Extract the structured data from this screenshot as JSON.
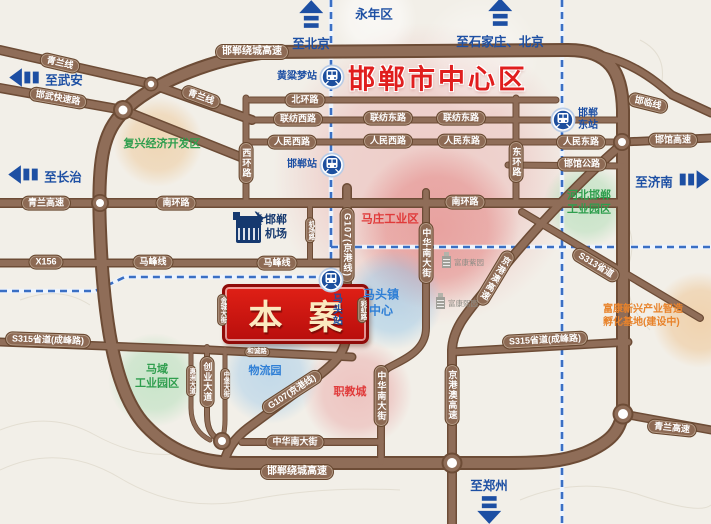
{
  "title": {
    "text": "邯郸市中心区",
    "x": 438,
    "y": 77,
    "color": "#e01e1e"
  },
  "project": {
    "label": "本案",
    "x": 222,
    "y": 284,
    "w": 141,
    "h": 54,
    "color": "#c41412"
  },
  "airport": {
    "line1": "邯郸",
    "line2": "机场"
  },
  "palette": {
    "road": "#8d6a54",
    "road_edge": "#6d4c36",
    "railway": "#3a6fc4",
    "direction": "#1d4fa3"
  },
  "directions": [
    {
      "label": "至北京",
      "arrow": "up",
      "axis": "col",
      "order": "arrow-first",
      "x": 311,
      "y": 26
    },
    {
      "label": "永年区",
      "arrow": "none",
      "axis": "row",
      "order": "text-first",
      "x": 374,
      "y": 13
    },
    {
      "label": "至石家庄、北京",
      "arrow": "up",
      "axis": "col",
      "order": "arrow-first",
      "x": 500,
      "y": 24
    },
    {
      "label": "至武安",
      "arrow": "left",
      "axis": "row",
      "order": "arrow-first",
      "x": 46,
      "y": 79
    },
    {
      "label": "至长治",
      "arrow": "left",
      "axis": "row",
      "order": "arrow-first",
      "x": 45,
      "y": 176
    },
    {
      "label": "至济南",
      "arrow": "right",
      "axis": "row",
      "order": "text-first",
      "x": 672,
      "y": 181
    },
    {
      "label": "至郑州",
      "arrow": "down",
      "axis": "col",
      "order": "text-first",
      "x": 489,
      "y": 501
    }
  ],
  "zone_circles": [
    {
      "name": "city-center",
      "cx": 425,
      "cy": 175,
      "r": 152,
      "color": "#e89b9b",
      "opacity": 0.42
    },
    {
      "name": "mazhuang",
      "cx": 437,
      "cy": 228,
      "r": 82,
      "color": "#e06a6a",
      "opacity": 0.45
    },
    {
      "name": "matou-center",
      "cx": 393,
      "cy": 300,
      "r": 50,
      "color": "#8fc3e8",
      "opacity": 0.55
    },
    {
      "name": "logistics-park",
      "cx": 270,
      "cy": 374,
      "r": 50,
      "color": "#9cc8ea",
      "opacity": 0.55
    },
    {
      "name": "zhijiaocheng",
      "cx": 357,
      "cy": 393,
      "r": 55,
      "color": "#e89a9a",
      "opacity": 0.5
    },
    {
      "name": "fuxing",
      "cx": 158,
      "cy": 142,
      "r": 45,
      "color": "#ecc28c",
      "opacity": 0.55
    },
    {
      "name": "hebei-handan-park",
      "cx": 586,
      "cy": 205,
      "r": 43,
      "color": "#9ed8a8",
      "opacity": 0.5
    },
    {
      "name": "mayu-park",
      "cx": 155,
      "cy": 380,
      "r": 47,
      "color": "#a8dcb2",
      "opacity": 0.55
    },
    {
      "name": "fukang-base",
      "cx": 700,
      "cy": 320,
      "r": 48,
      "color": "#eec089",
      "opacity": 0.6
    },
    {
      "name": "yongnian-halo",
      "cx": 375,
      "cy": 18,
      "r": 42,
      "color": "#ffffff",
      "opacity": 0.55
    },
    {
      "name": "center-halo",
      "cx": 480,
      "cy": 55,
      "r": 60,
      "color": "#ffffff",
      "opacity": 0.3
    }
  ],
  "zone_labels": [
    {
      "lines": [
        "复兴经济开发区"
      ],
      "x": 162,
      "y": 144,
      "color": "#2f9e4e",
      "size": 11
    },
    {
      "lines": [
        "马庄工业区"
      ],
      "x": 390,
      "y": 220,
      "color": "#e03a3a",
      "size": 11.5
    },
    {
      "lines": [
        "河北邯郸",
        "工业园区"
      ],
      "x": 589,
      "y": 203,
      "color": "#2f9e4e",
      "size": 11
    },
    {
      "lines": [
        "马头镇",
        "中心"
      ],
      "x": 381,
      "y": 303,
      "color": "#2f7fd6",
      "size": 12
    },
    {
      "lines": [
        "物流园"
      ],
      "x": 265,
      "y": 371,
      "color": "#2f7fd6",
      "size": 11
    },
    {
      "lines": [
        "职教城"
      ],
      "x": 350,
      "y": 392,
      "color": "#e03a3a",
      "size": 11
    },
    {
      "lines": [
        "马域",
        "工业园区"
      ],
      "x": 157,
      "y": 377,
      "color": "#2f9e4e",
      "size": 11
    },
    {
      "lines": [
        "富康新兴产业智造",
        "孵化基地(建设中)"
      ],
      "x": 603,
      "y": 316,
      "color": "#e8832b",
      "size": 10,
      "align": "left"
    }
  ],
  "stations": [
    {
      "label": "黄粱梦站",
      "x": 332,
      "y": 77,
      "labelPos": "left"
    },
    {
      "label": "邯郸站",
      "x": 332,
      "y": 165,
      "labelPos": "left"
    },
    {
      "label": "邯郸东站",
      "lines": [
        "邯郸",
        "东站"
      ],
      "x": 563,
      "y": 120,
      "labelPos": "right"
    },
    {
      "label": "马头站",
      "x": 331,
      "y": 280,
      "labelPos": "below-vert"
    }
  ],
  "companies": [
    {
      "label": "富康紫园",
      "x": 442,
      "y": 262
    },
    {
      "label": "富康熙园",
      "x": 436,
      "y": 303
    }
  ],
  "road_labels": [
    {
      "label": "邯郸绕城高速",
      "x": 252,
      "y": 52,
      "size": 10
    },
    {
      "label": "青兰线",
      "x": 60,
      "y": 63,
      "rot": 13
    },
    {
      "label": "青兰线",
      "x": 201,
      "y": 97,
      "rot": 20
    },
    {
      "label": "邯武快速路",
      "x": 58,
      "y": 98,
      "rot": 10
    },
    {
      "label": "青兰高速",
      "x": 46,
      "y": 203
    },
    {
      "label": "南环路",
      "x": 176,
      "y": 203
    },
    {
      "label": "南环路",
      "x": 465,
      "y": 202
    },
    {
      "label": "X156",
      "x": 46,
      "y": 262
    },
    {
      "label": "马峰线",
      "x": 153,
      "y": 262
    },
    {
      "label": "马峰线",
      "x": 277,
      "y": 263
    },
    {
      "label": "S315省道(成峰路)",
      "x": 48,
      "y": 340,
      "rot": 2
    },
    {
      "label": "S315省道(成峰路)",
      "x": 545,
      "y": 340,
      "rot": -3
    },
    {
      "label": "S313省道",
      "x": 596,
      "y": 265,
      "rot": 31
    },
    {
      "label": "青兰高速",
      "x": 672,
      "y": 428,
      "rot": 6
    },
    {
      "label": "邯郸绕城高速",
      "x": 297,
      "y": 472,
      "size": 10
    },
    {
      "label": "中华南大街",
      "x": 295,
      "y": 442
    },
    {
      "label": "北环路",
      "x": 305,
      "y": 100
    },
    {
      "label": "联纺西路",
      "x": 298,
      "y": 119
    },
    {
      "label": "联纺东路",
      "x": 388,
      "y": 118
    },
    {
      "label": "联纺东路",
      "x": 461,
      "y": 118
    },
    {
      "label": "人民西路",
      "x": 292,
      "y": 142
    },
    {
      "label": "人民西路",
      "x": 388,
      "y": 141
    },
    {
      "label": "人民东路",
      "x": 462,
      "y": 141
    },
    {
      "label": "人民东路",
      "x": 581,
      "y": 142
    },
    {
      "label": "邯临线",
      "x": 648,
      "y": 103,
      "rot": 14
    },
    {
      "label": "邯馆高速",
      "x": 673,
      "y": 140
    },
    {
      "label": "邯馆公路",
      "x": 582,
      "y": 164
    },
    {
      "label": "和诚路",
      "x": 257,
      "y": 352,
      "small": true
    },
    {
      "label": "G107(京港线)",
      "x": 292,
      "y": 392,
      "rot": -33
    },
    {
      "label": "西环路",
      "x": 246,
      "y": 163,
      "vert": true
    },
    {
      "label": "东环路",
      "x": 516,
      "y": 162,
      "vert": true
    },
    {
      "label": "机场路",
      "x": 310,
      "y": 230,
      "vert": true,
      "small": true
    },
    {
      "label": "G107(京港线)",
      "x": 347,
      "y": 245,
      "vert": true
    },
    {
      "label": "中华南大街",
      "x": 426,
      "y": 253,
      "vert": true
    },
    {
      "label": "京港澳高速",
      "x": 495,
      "y": 278,
      "vert": true,
      "rot": 31
    },
    {
      "label": "中华南大街",
      "x": 381,
      "y": 396,
      "vert": true
    },
    {
      "label": "京港澳高速",
      "x": 452,
      "y": 395,
      "vert": true
    },
    {
      "label": "创业大道",
      "x": 207,
      "y": 382,
      "vert": true
    },
    {
      "label": "惠洲大道",
      "x": 191,
      "y": 381,
      "vert": true,
      "small": true
    },
    {
      "label": "中堡大街",
      "x": 225,
      "y": 384,
      "vert": true,
      "small": true
    },
    {
      "label": "金城大街",
      "x": 222,
      "y": 310,
      "vert": true,
      "small": true
    },
    {
      "label": "彩虹路",
      "x": 362,
      "y": 310,
      "vert": true,
      "small": true
    }
  ]
}
